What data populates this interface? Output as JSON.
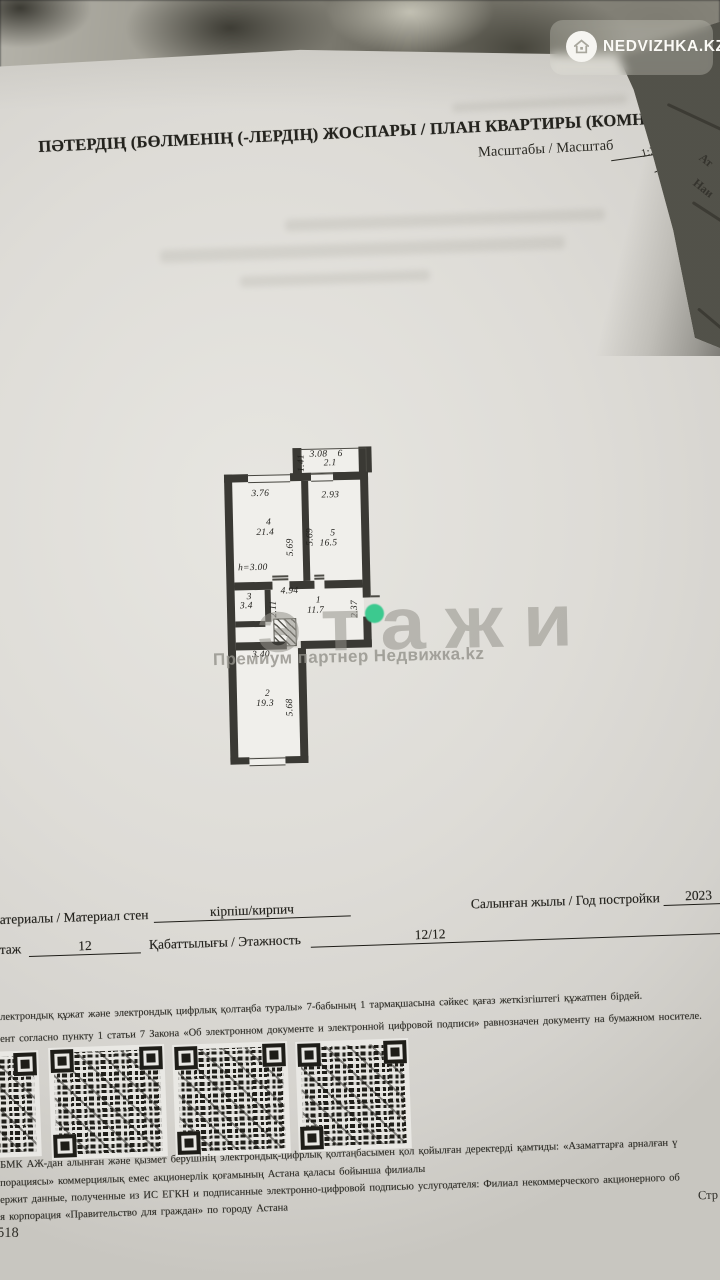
{
  "logo": {
    "text": "NEDVIZHKA.KZ",
    "icon": "house-icon"
  },
  "header": {
    "title": "ПӘТЕРДІҢ (БӨЛМЕНІҢ (-ЛЕРДІҢ) ЖОСПАРЫ / ПЛАН КВАРТИРЫ (КОМНАТ (-Ы)",
    "scale_label": "Масштабы / Масштаб",
    "scale_value": "1:200"
  },
  "side_page": {
    "fragments": [
      "Ат",
      "Наи"
    ]
  },
  "plan": {
    "ceiling_height": "h=3.00",
    "labels": [
      {
        "t": "1.41",
        "x": 76,
        "y": 26,
        "dir": "v"
      },
      {
        "t": "3.08",
        "x": 89,
        "y": 4,
        "dir": "h"
      },
      {
        "t": "6",
        "x": 117,
        "y": 4,
        "dir": "h"
      },
      {
        "t": "2.1",
        "x": 103,
        "y": 13,
        "dir": "h"
      },
      {
        "t": "3.76",
        "x": 30,
        "y": 42,
        "dir": "h"
      },
      {
        "t": "2.93",
        "x": 100,
        "y": 45,
        "dir": "h"
      },
      {
        "t": "4",
        "x": 44,
        "y": 71,
        "dir": "h"
      },
      {
        "t": "21.4",
        "x": 34,
        "y": 81,
        "dir": "h"
      },
      {
        "t": "5.69",
        "x": 63,
        "y": 110,
        "dir": "v"
      },
      {
        "t": "5.69",
        "x": 83,
        "y": 100,
        "dir": "v"
      },
      {
        "t": "5",
        "x": 108,
        "y": 83,
        "dir": "h"
      },
      {
        "t": "16.5",
        "x": 97,
        "y": 93,
        "dir": "h"
      },
      {
        "t": "h=3.00",
        "x": 15,
        "y": 116,
        "dir": "h"
      },
      {
        "t": "3",
        "x": 23,
        "y": 145,
        "dir": "h"
      },
      {
        "t": "3.4",
        "x": 16,
        "y": 154,
        "dir": "h"
      },
      {
        "t": "2.11",
        "x": 45,
        "y": 171,
        "dir": "v"
      },
      {
        "t": "4.94",
        "x": 57,
        "y": 140,
        "dir": "h"
      },
      {
        "t": "1",
        "x": 92,
        "y": 150,
        "dir": "h"
      },
      {
        "t": "11.7",
        "x": 83,
        "y": 160,
        "dir": "h"
      },
      {
        "t": "2.37",
        "x": 126,
        "y": 173,
        "dir": "v"
      },
      {
        "t": "3.40",
        "x": 27,
        "y": 203,
        "dir": "h"
      },
      {
        "t": "2",
        "x": 39,
        "y": 242,
        "dir": "h"
      },
      {
        "t": "19.3",
        "x": 30,
        "y": 252,
        "dir": "h"
      },
      {
        "t": "5.68",
        "x": 59,
        "y": 270,
        "dir": "v"
      }
    ]
  },
  "watermark": {
    "brand": "этажи",
    "tagline": "Премиум партнер Недвижка.kz",
    "accent_color": "#3cc98f"
  },
  "details": {
    "materials_label": "атериалы / Материал стен",
    "materials_value": "кірпіш/кирпич",
    "year_label": "Салынған жылы / Год постройки",
    "year_value": "2023",
    "floor_label": "таж",
    "floor_value": "12",
    "floors_label": "Қабаттылығы / Этажность",
    "floors_value": "12/12"
  },
  "legal_top": {
    "lines": [
      "лектрондық құжат және электрондық цифрлық қолтаңба туралы» 7-бабының 1 тармақшасына сәйкес қағаз жеткізгіштегі құжатпен бірдей.",
      "ент согласно пункту 1 статьи 7 Закона «Об электронном документе и электронной цифровой подписи» равнозначен документу на бумажном носителе."
    ]
  },
  "legal_bottom": {
    "lines": [
      "БМК АЖ-дан алынған және қызмет берушінің электрондық-цифрлық қолтаңбасымен қол қойылған деректерді қамтиды: «Азаматтарға арналған ү",
      "порациясы» коммерциялық емес акционерлік қоғамының Астана қаласы бойынша филиалы",
      "ержит данные, полученные из ИС ЕГКН и подписанные электронно-цифровой подписью услугодателя: Филиал некоммерческого акционерного об",
      "я корпорация «Правительство для граждан» по городу Астана"
    ],
    "page_marker": "Стр",
    "page_number": "518"
  }
}
